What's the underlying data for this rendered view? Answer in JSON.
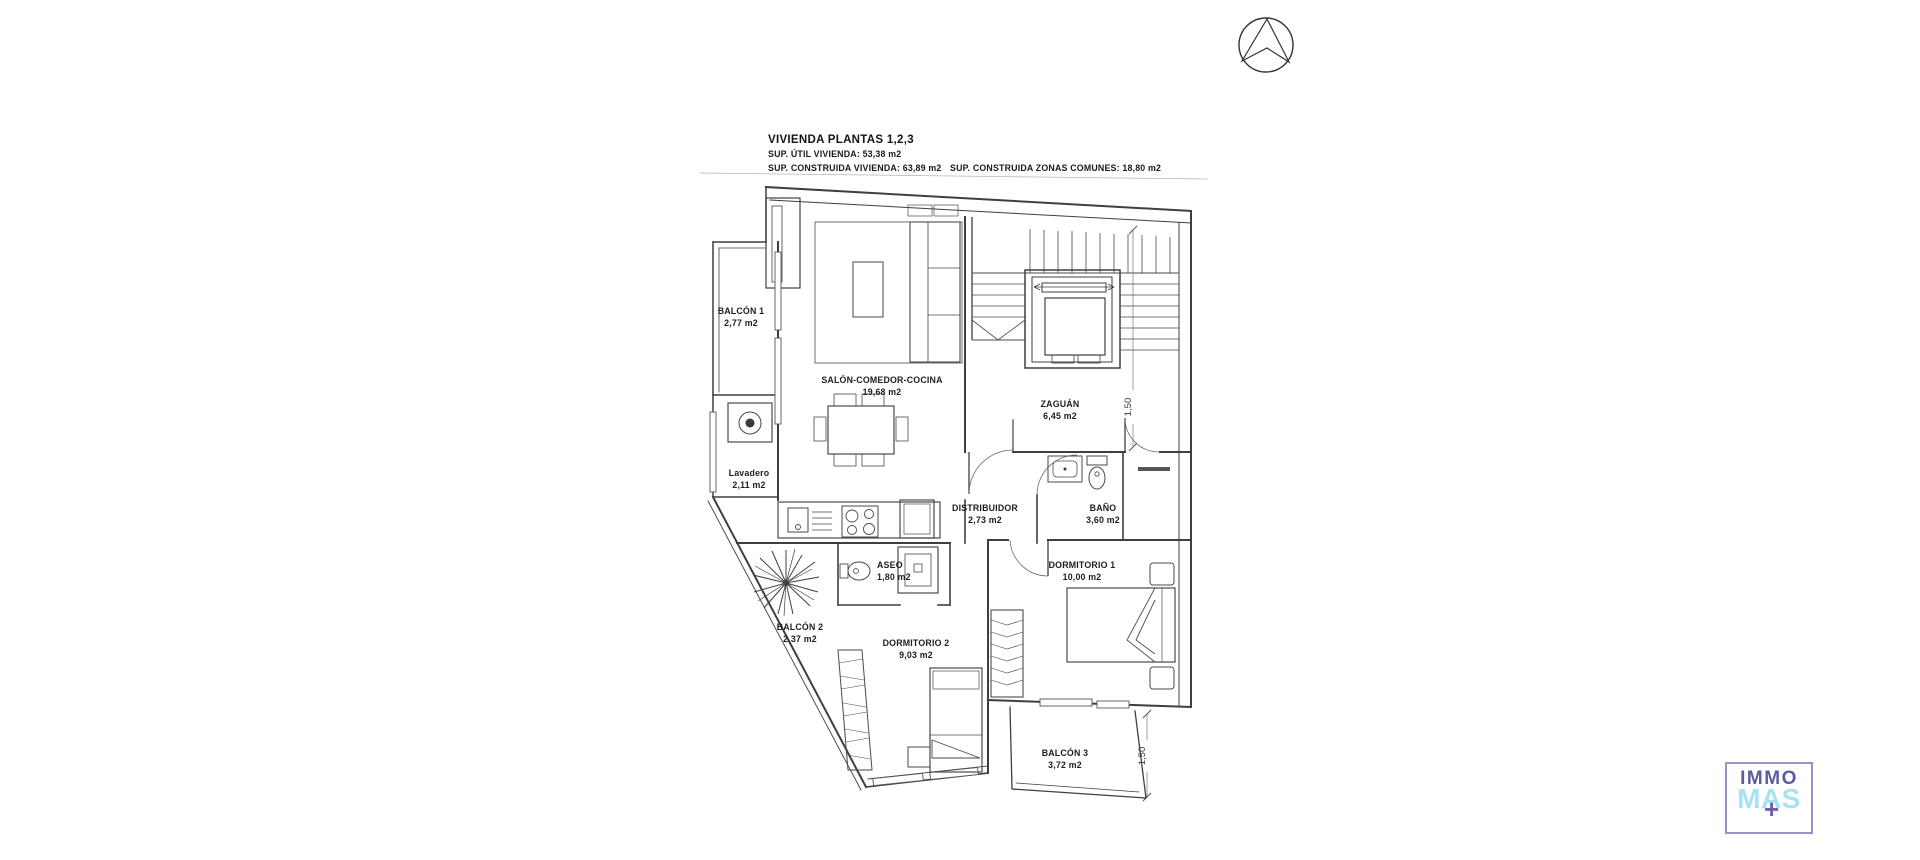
{
  "title_block": {
    "title": "VIVIENDA PLANTAS 1,2,3",
    "line_util": "SUP. ÚTIL VIVIENDA: 53,38 m2",
    "line_construida": "SUP. CONSTRUIDA VIVIENDA: 63,89 m2",
    "line_comunes": "SUP. CONSTRUIDA ZONAS COMUNES: 18,80 m2"
  },
  "rooms": {
    "balcon1": {
      "name": "BALCÓN 1",
      "area": "2,77 m2"
    },
    "salon": {
      "name": "SALÓN-COMEDOR-COCINA",
      "area": "19,68 m2"
    },
    "zaguan": {
      "name": "ZAGUÁN",
      "area": "6,45 m2"
    },
    "lavadero": {
      "name": "Lavadero",
      "area": "2,11 m2"
    },
    "distribuidor": {
      "name": "DISTRIBUIDOR",
      "area": "2,73 m2"
    },
    "bano": {
      "name": "BAÑO",
      "area": "3,60 m2"
    },
    "aseo": {
      "name": "ASEO",
      "area": "1,80 m2"
    },
    "dormitorio1": {
      "name": "DORMITORIO 1",
      "area": "10,00 m2"
    },
    "balcon2": {
      "name": "BALCÓN 2",
      "area": "2,37 m2"
    },
    "dormitorio2": {
      "name": "DORMITORIO 2",
      "area": "9,03 m2"
    },
    "balcon3": {
      "name": "BALCÓN 3",
      "area": "3,72 m2"
    }
  },
  "dimensions": {
    "zaguan_dim": "1,50",
    "balcon3_dim": "1,50"
  },
  "logo": {
    "line1": "IMMO",
    "line2": "MAS",
    "plus": "+",
    "colors": {
      "purple": "#5b5ca0",
      "cyan": "#a6e4f2",
      "plus": "#6a5fae",
      "border": "#9a93c8"
    }
  }
}
